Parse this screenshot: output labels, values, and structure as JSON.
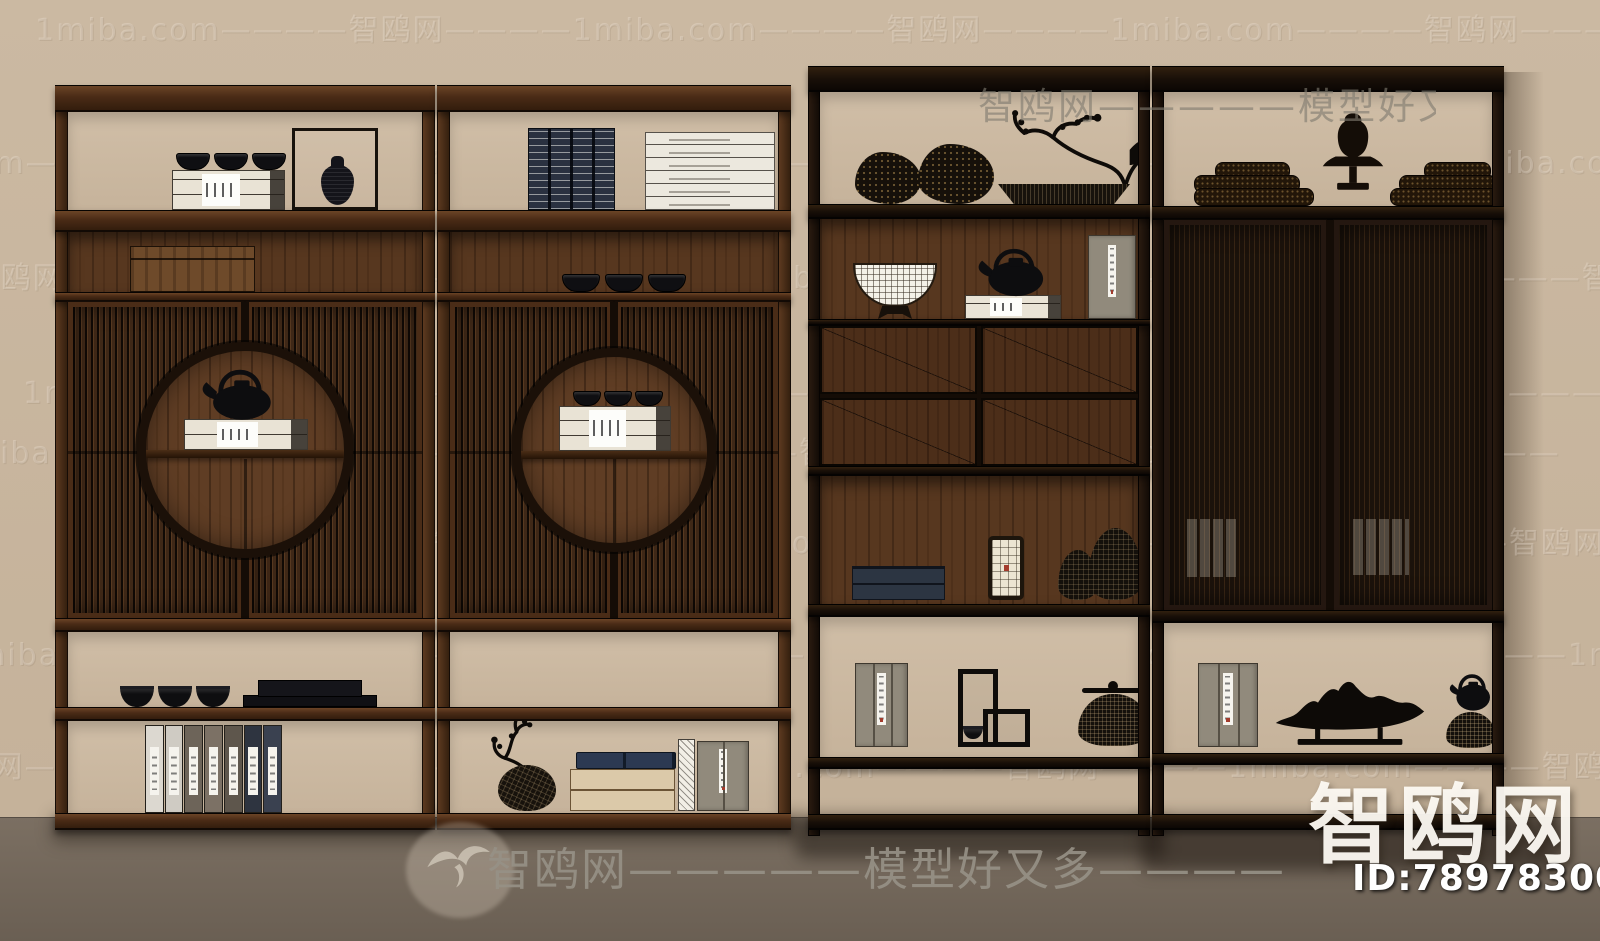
{
  "watermarks": {
    "tile_row": "1miba.com————智鸥网————1miba.com————智鸥网————1miba.com————智鸥网————1miba.com————智鸥网————",
    "top_banner": "智鸥网—————模型好又多————",
    "bottom_banner": "智鸥网—————模型好又多————",
    "brand_logo": "智鸥网",
    "id_label": "ID:789783008"
  },
  "colors": {
    "wall": "#c6b39b",
    "floor": "#6f6357",
    "wood_medium": "#57371f",
    "wood_frame": "#4a2b16",
    "frame_black": "#1a1109",
    "watermark_white": "#fff8ed"
  }
}
